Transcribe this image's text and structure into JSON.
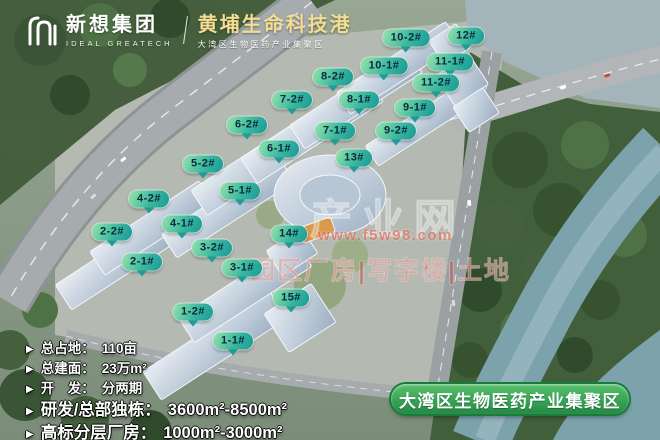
{
  "header": {
    "company_cn": "新想集团",
    "company_en": "IDEAL GREATECH",
    "project_title": "黄埔生命科技港",
    "project_subtitle": "大湾区生物医药产业集聚区"
  },
  "building_labels": [
    {
      "label": "10-2#",
      "x": 406,
      "y": 38
    },
    {
      "label": "12#",
      "x": 466,
      "y": 36
    },
    {
      "label": "10-1#",
      "x": 384,
      "y": 66
    },
    {
      "label": "11-1#",
      "x": 450,
      "y": 62
    },
    {
      "label": "8-2#",
      "x": 333,
      "y": 77
    },
    {
      "label": "11-2#",
      "x": 436,
      "y": 83
    },
    {
      "label": "7-2#",
      "x": 292,
      "y": 100
    },
    {
      "label": "8-1#",
      "x": 359,
      "y": 100
    },
    {
      "label": "9-1#",
      "x": 415,
      "y": 108
    },
    {
      "label": "6-2#",
      "x": 247,
      "y": 125
    },
    {
      "label": "7-1#",
      "x": 335,
      "y": 131
    },
    {
      "label": "9-2#",
      "x": 396,
      "y": 131
    },
    {
      "label": "6-1#",
      "x": 279,
      "y": 149
    },
    {
      "label": "13#",
      "x": 354,
      "y": 158
    },
    {
      "label": "5-2#",
      "x": 203,
      "y": 164
    },
    {
      "label": "5-1#",
      "x": 240,
      "y": 191
    },
    {
      "label": "4-2#",
      "x": 149,
      "y": 199
    },
    {
      "label": "4-1#",
      "x": 182,
      "y": 224
    },
    {
      "label": "14#",
      "x": 289,
      "y": 234
    },
    {
      "label": "2-2#",
      "x": 112,
      "y": 232
    },
    {
      "label": "3-2#",
      "x": 212,
      "y": 248
    },
    {
      "label": "2-1#",
      "x": 142,
      "y": 262
    },
    {
      "label": "3-1#",
      "x": 242,
      "y": 268
    },
    {
      "label": "15#",
      "x": 291,
      "y": 298
    },
    {
      "label": "1-2#",
      "x": 193,
      "y": 312
    },
    {
      "label": "1-1#",
      "x": 233,
      "y": 341
    }
  ],
  "stats": {
    "bullet": "▶",
    "items": [
      {
        "label": "总占地：",
        "value": "110亩"
      },
      {
        "label": "总建面：",
        "value": "23万m²"
      },
      {
        "label": "开　发：",
        "value": "分两期"
      },
      {
        "label": "研发/总部独栋：",
        "value": "3600m²-8500m²"
      },
      {
        "label": "高标分层厂房：",
        "value": "1000m²-3000m²"
      }
    ]
  },
  "banner": {
    "text": "大湾区生物医药产业集聚区"
  },
  "watermark": {
    "big_text": "产业网",
    "url": "www.f5w98.com",
    "row_text": "园区厂房|写字楼|土地"
  },
  "colors": {
    "bubble_green": "#3cb89f",
    "banner_green": "#2e9b4e",
    "title_yellow": "#f3dd92"
  }
}
